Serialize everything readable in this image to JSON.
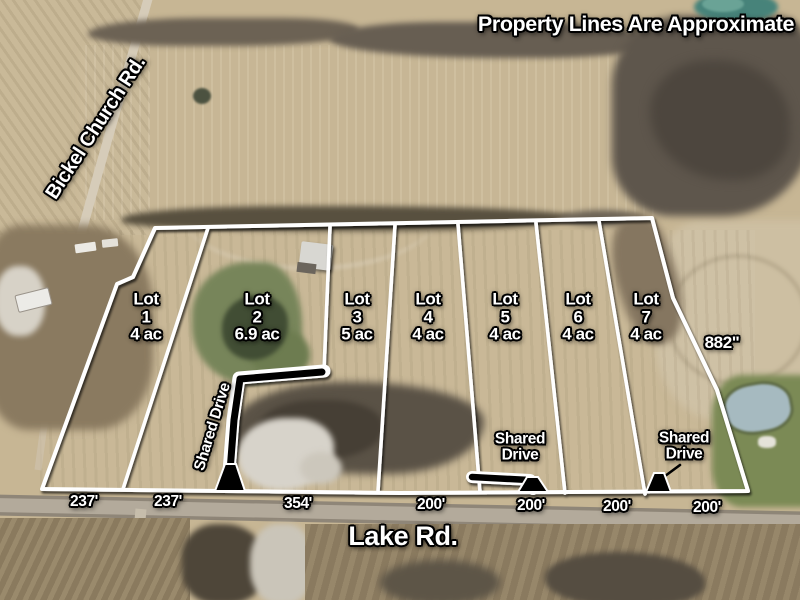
{
  "disclaimer": "Property Lines Are Approximate",
  "roads": {
    "left_road": "Bickel Church Rd.",
    "bottom_road": "Lake Rd."
  },
  "lots": [
    {
      "label": "Lot",
      "number": "1",
      "acreage": "4 ac"
    },
    {
      "label": "Lot",
      "number": "2",
      "acreage": "6.9 ac"
    },
    {
      "label": "Lot",
      "number": "3",
      "acreage": "5 ac"
    },
    {
      "label": "Lot",
      "number": "4",
      "acreage": "4 ac"
    },
    {
      "label": "Lot",
      "number": "5",
      "acreage": "4 ac"
    },
    {
      "label": "Lot",
      "number": "6",
      "acreage": "4 ac"
    },
    {
      "label": "Lot",
      "number": "7",
      "acreage": "4 ac"
    }
  ],
  "boundary_note": "882\"",
  "frontages": [
    "237'",
    "237'",
    "354'",
    "200'",
    "200'",
    "200'",
    "200'"
  ],
  "shared_drives": [
    {
      "orientation": "rotated",
      "label": "Shared Drive"
    },
    {
      "orientation": "stacked",
      "line1": "Shared",
      "line2": "Drive"
    },
    {
      "orientation": "stacked",
      "line1": "Shared",
      "line2": "Drive"
    }
  ],
  "colors": {
    "property_line": "#ffffff",
    "drive_fill": "#000000",
    "label_text": "#ffffff"
  }
}
